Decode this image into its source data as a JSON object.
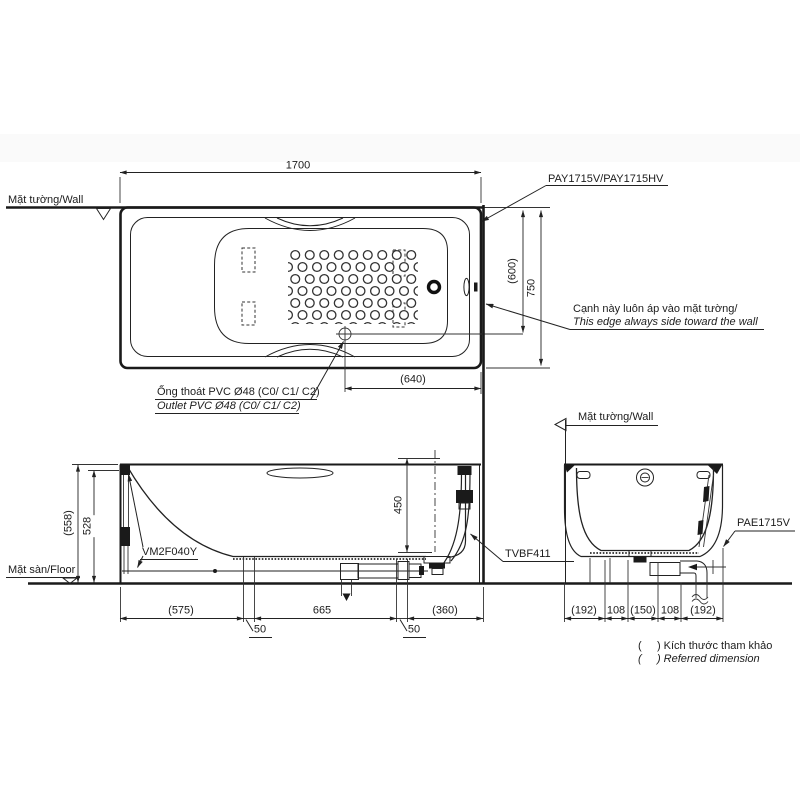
{
  "top_view": {
    "dim_length": "1700",
    "wall_label": "Mặt tường/Wall",
    "model_label": "PAY1715V/PAY1715HV",
    "dim_inner_width": "(600)",
    "dim_width": "750",
    "wall_edge_note_vi": "Cạnh này luôn áp vào mặt tường/",
    "wall_edge_note_en": "This edge always side toward the wall",
    "dim_drain_offset": "(640)",
    "outlet_note_vi": "Ống thoát PVC Ø48 (C0/ C1/ C2)",
    "outlet_note_en": "Outlet PVC Ø48 (C0/ C1/ C2)"
  },
  "side_view": {
    "dim_total_height": "(558)",
    "dim_rim_height": "528",
    "dim_depth": "450",
    "legs_label": "VM2F040Y",
    "waste_kit_label": "TVBF411",
    "floor_label": "Mặt sàn/Floor",
    "dims_bottom": [
      "(575)",
      "50",
      "665",
      "50",
      "(360)"
    ]
  },
  "end_view": {
    "wall_label": "Mặt tường/Wall",
    "model_label": "PAE1715V",
    "dims_bottom": [
      "(192)",
      "108",
      "(150)",
      "108",
      "(192)"
    ]
  },
  "notes": {
    "reference_vi": "(     ) Kích thước tham khảo",
    "reference_en": "(     ) Referred dimension"
  }
}
